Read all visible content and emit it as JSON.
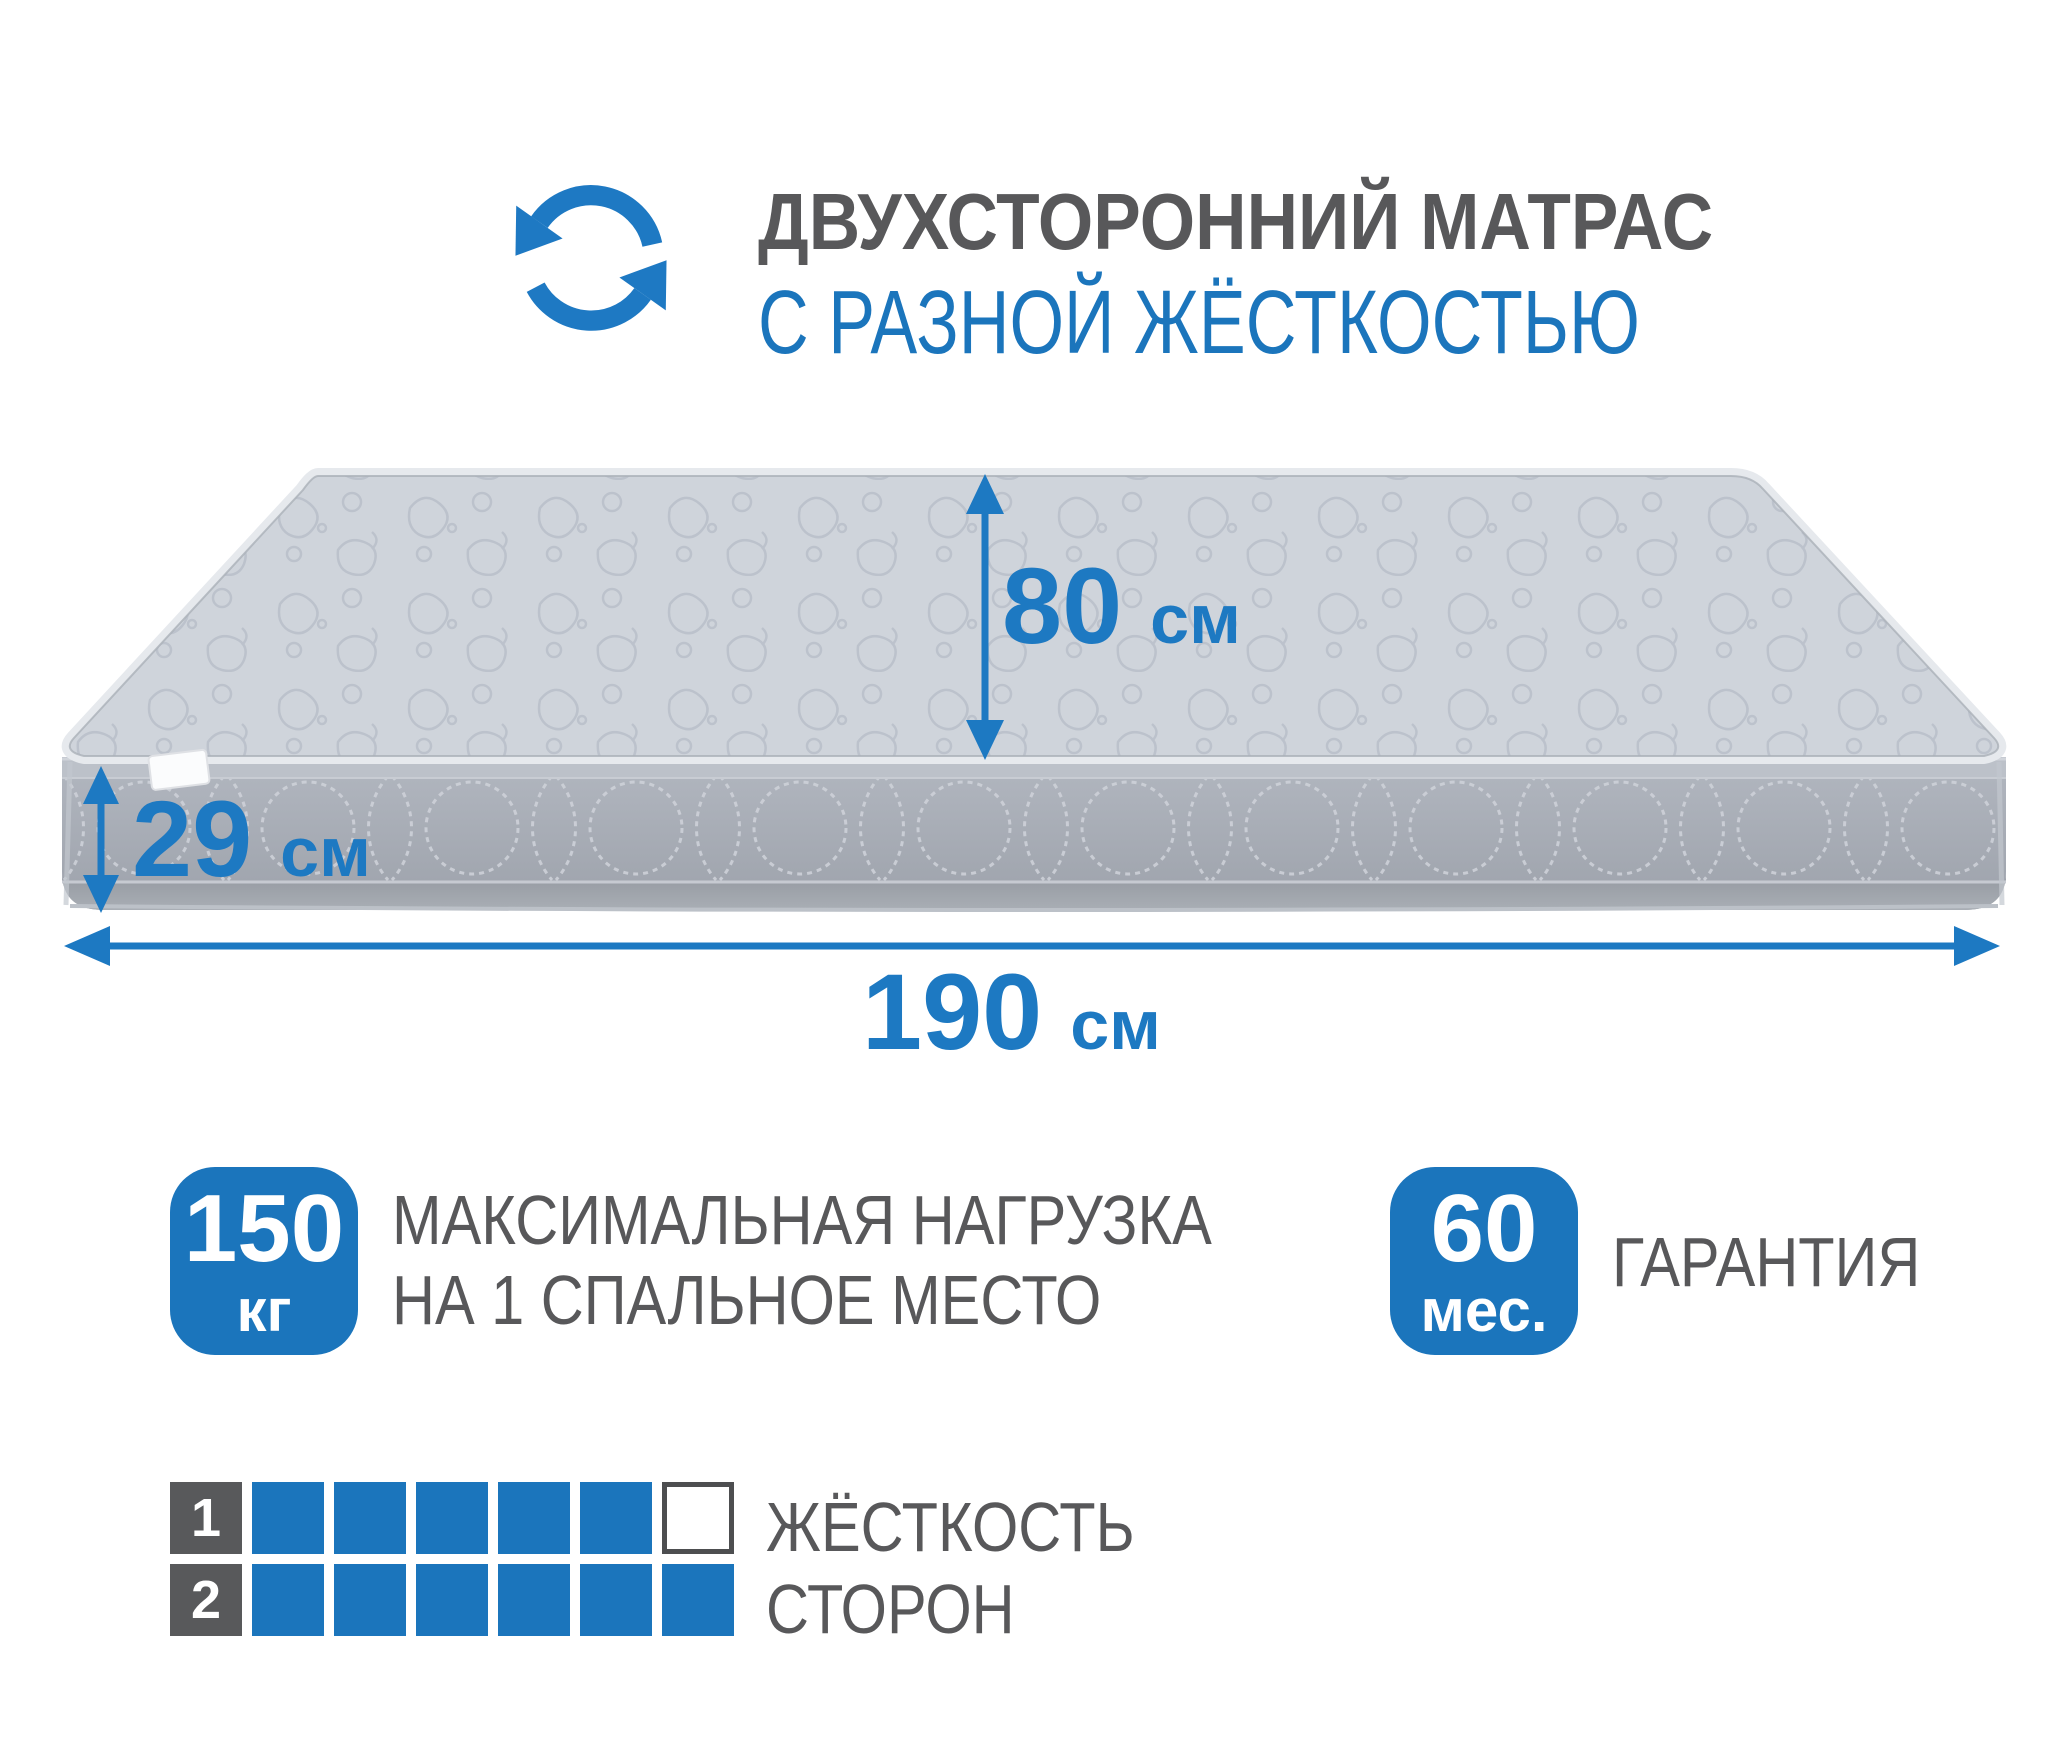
{
  "colors": {
    "accent_blue": "#1b75bc",
    "arrow_blue": "#1d79c2",
    "text_gray": "#58585a",
    "square_dark": "#58595b",
    "mattress_top": "#cfd4db",
    "mattress_side": "#a8adb6"
  },
  "header": {
    "icon": "rotate-arrows",
    "title_line1": "ДВУХСТОРОННИЙ МАТРАС",
    "title_line2": "С РАЗНОЙ ЖЁСТКОСТЬЮ"
  },
  "dimensions": {
    "width": {
      "value": "80",
      "unit": "см"
    },
    "thickness": {
      "value": "29",
      "unit": "см"
    },
    "length": {
      "value": "190",
      "unit": "см"
    }
  },
  "features": {
    "max_load": {
      "badge_value": "150",
      "badge_unit": "кг",
      "label_line1": "МАКСИМАЛЬНАЯ НАГРУЗКА",
      "label_line2": "НА 1 СПАЛЬНОЕ МЕСТО"
    },
    "warranty": {
      "badge_value": "60",
      "badge_unit": "мес.",
      "label": "ГАРАНТИЯ"
    }
  },
  "firmness": {
    "label_line1": "ЖЁСТКОСТЬ",
    "label_line2": "СТОРОН",
    "scale_total": 6,
    "rows": [
      {
        "side": "1",
        "filled": 5
      },
      {
        "side": "2",
        "filled": 6
      }
    ]
  }
}
